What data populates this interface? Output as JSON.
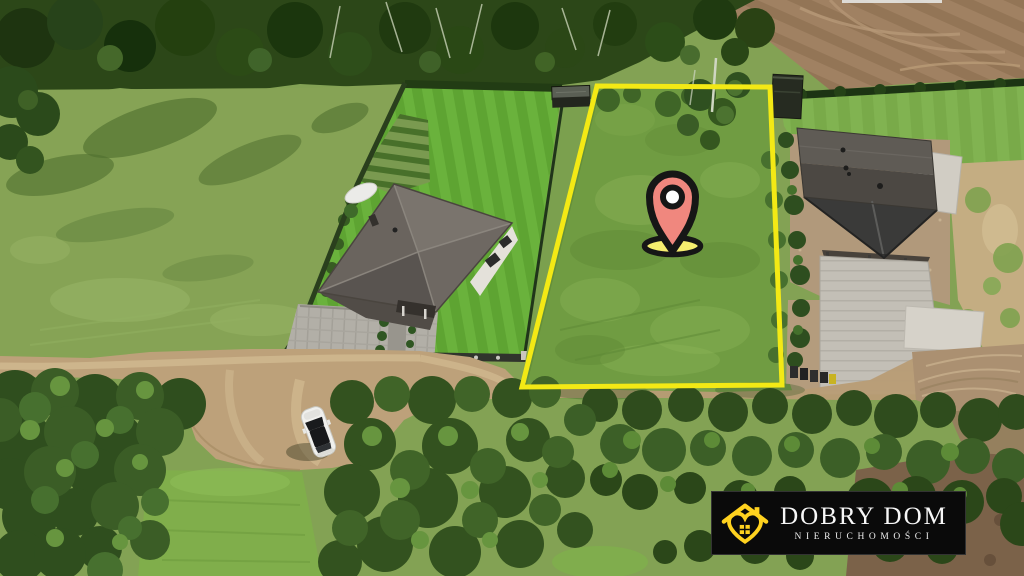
{
  "photo": {
    "description": "Aerial drone photo of a grassy building plot outlined in yellow, between two single-family houses, with forest above, a plowed field top-right, a dirt road, a white parked car and a tree row in the foreground",
    "palette": {
      "forest": "#2c4718",
      "meadow": "#86a355",
      "plot_grass": "#709c42",
      "road": "#bda17a",
      "lawn_stripe_a": "#5ea432",
      "lawn_stripe_b": "#6ab23c",
      "left_roof": "#6a645e",
      "right_roof": "#4c4843",
      "driveway": "#c3bfb6"
    }
  },
  "overlays": {
    "plot_boundary": {
      "shape": "quadrilateral",
      "color": "#f3e915"
    },
    "location_marker": {
      "icon": "location-pin-icon",
      "pin_fill": "#f0877e",
      "outline_color": "#161616",
      "center_fill": "#ffffff",
      "base_fill": "#f6ee6f"
    }
  },
  "branding": {
    "banner": {
      "title": "DOBRY DOM",
      "subtitle": "NIERUCHOMOŚCI",
      "background_color": "#0a0a0a",
      "border_color": "#333333",
      "title_color": "#f7f7f7",
      "subtitle_color": "#ededed",
      "logo_icon": "house-heart-logo-icon",
      "logo_color": "#ffd21f"
    }
  }
}
